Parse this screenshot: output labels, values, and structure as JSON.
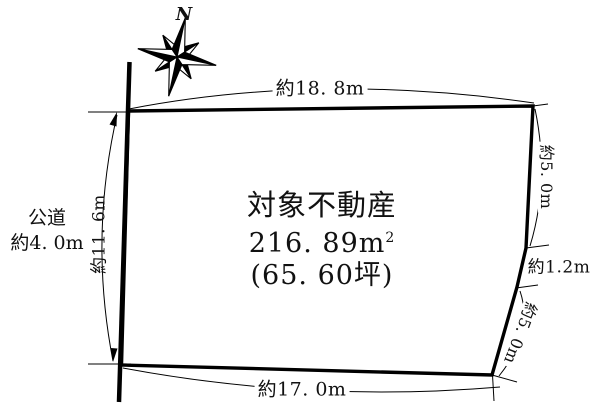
{
  "compass": {
    "north_label": "N"
  },
  "road_label": {
    "line1": "公道",
    "line2": "約4. 0m"
  },
  "parcel": {
    "name": "対象不動産",
    "area_sqm_value": "216. 89",
    "area_sqm_unit": "m",
    "area_sqm_exponent": "2",
    "area_tsubo": "(65. 60坪)"
  },
  "dimensions": {
    "top_width": "約18. 8m",
    "bottom_width": "約17. 0m",
    "left_height": "約11. 6m",
    "right_upper": "約5. 0m",
    "right_middle": "約1.2m",
    "right_lower": "約5. 0m"
  },
  "colors": {
    "line": "#000000",
    "background": "#ffffff"
  }
}
